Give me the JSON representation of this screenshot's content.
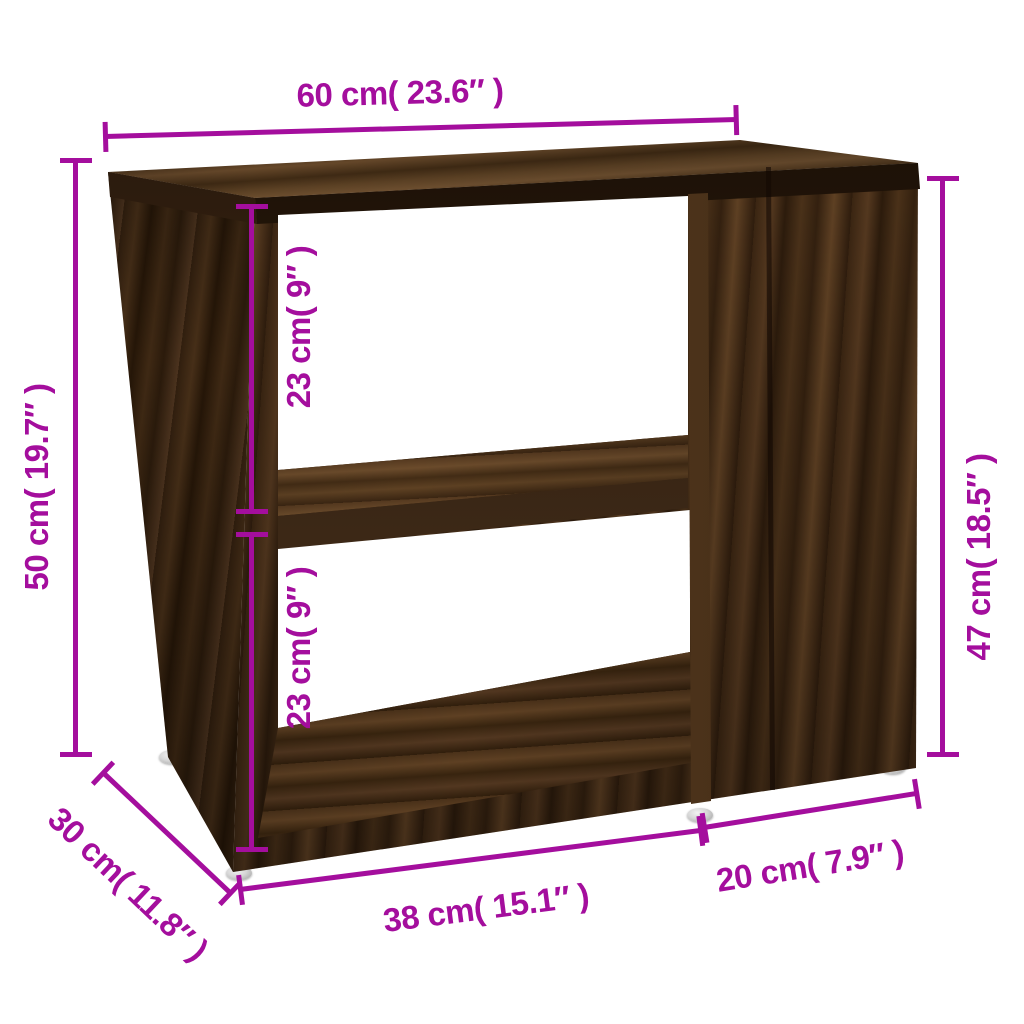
{
  "diagram": {
    "type": "furniture-dimension-diagram",
    "units": [
      "cm",
      "inch"
    ]
  },
  "colors": {
    "dimension_accent": "#A40E9D",
    "background": "#FFFFFF",
    "wood_dark": "#2B1A0D",
    "wood_mid": "#47301A",
    "wood_light": "#6B4C2E",
    "feet_silver": "#D6D6D6"
  },
  "dimensions": {
    "top_width": {
      "label": "60 cm( 23.6″ )",
      "cm": 60,
      "inch": 23.6
    },
    "left_height": {
      "label": "50 cm( 19.7″ )",
      "cm": 50,
      "inch": 19.7
    },
    "upper_compartment": {
      "label": "23 cm( 9″ )",
      "cm": 23,
      "inch": 9
    },
    "lower_compartment": {
      "label": "23 cm( 9″ )",
      "cm": 23,
      "inch": 9
    },
    "right_height": {
      "label": "47 cm( 18.5″ )",
      "cm": 47,
      "inch": 18.5
    },
    "depth": {
      "label": "30 cm( 11.8″ )",
      "cm": 30,
      "inch": 11.8
    },
    "bottom_open_width": {
      "label": "38 cm( 15.1″ )",
      "cm": 38,
      "inch": 15.1
    },
    "bottom_cabinet_width": {
      "label": "20 cm( 7.9″ )",
      "cm": 20,
      "inch": 7.9
    }
  }
}
